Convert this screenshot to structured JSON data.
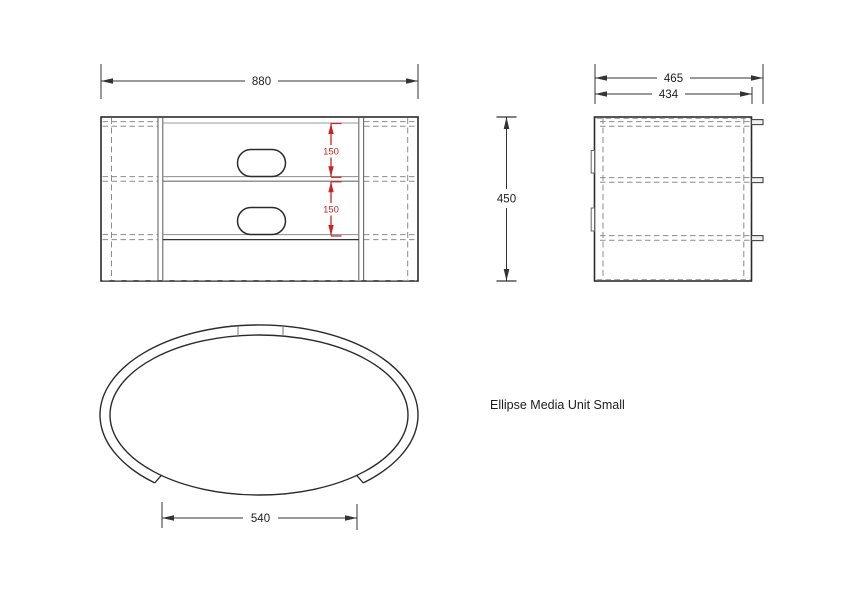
{
  "title_block": {
    "label": "Ellipse Media Unit Small"
  },
  "colors": {
    "outline": "#2b2b2b",
    "secondary_line": "#8c8c8c",
    "hidden_line": "#8c8c8c",
    "dimension_line": "#333333",
    "dimension_red": "#cc2222",
    "background": "#ffffff"
  },
  "views": {
    "front": {
      "name": "front-elevation",
      "dims": {
        "width": "880",
        "shelf_spacing": [
          "150",
          "150"
        ]
      }
    },
    "side": {
      "name": "side-elevation",
      "dims": {
        "depth_overall": "465",
        "depth_body": "434",
        "height": "450"
      }
    },
    "plan": {
      "name": "plan-view",
      "dims": {
        "front_opening_width": "540"
      }
    }
  }
}
